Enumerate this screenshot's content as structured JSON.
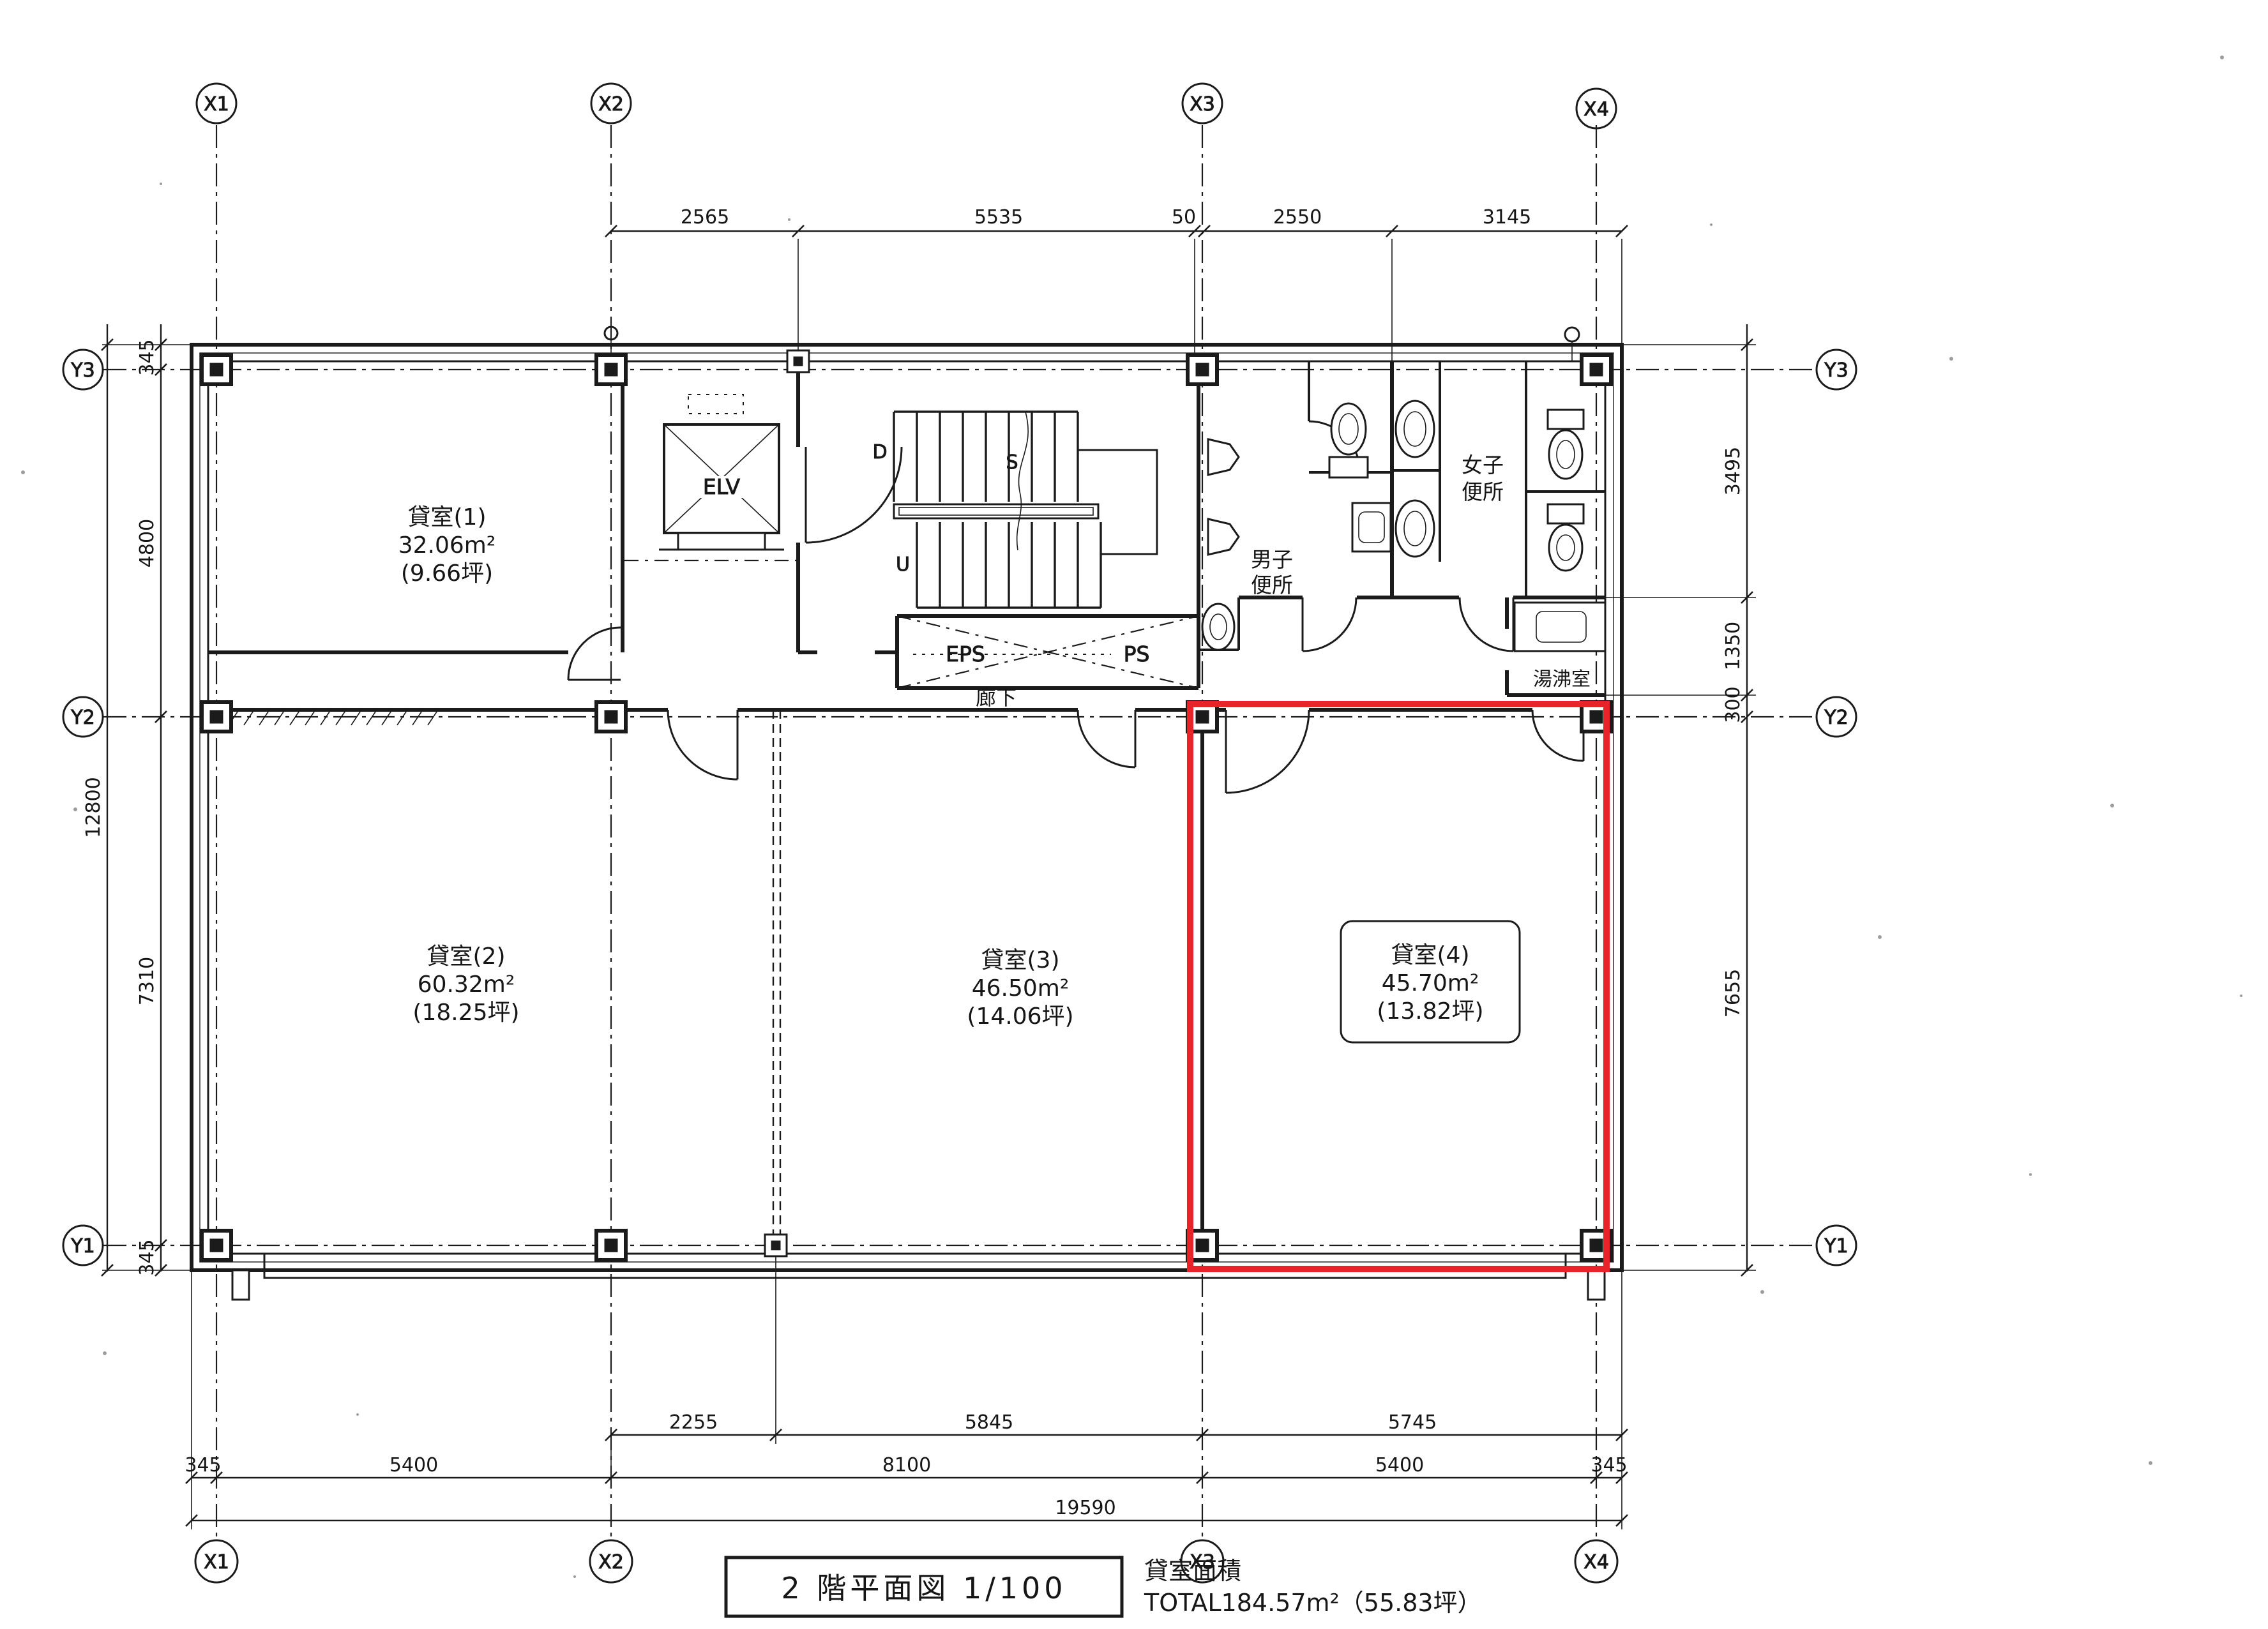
{
  "page": {
    "background": "#ffffff",
    "ink": "#1b1b1b",
    "highlight": "#e8232a"
  },
  "title_block": {
    "title": "2 階平面図  1/100"
  },
  "area_summary": {
    "heading": "貸室面積",
    "total": "TOTAL184.57m²（55.83坪）"
  },
  "grid": {
    "x": [
      "X1",
      "X2",
      "X3",
      "X4"
    ],
    "y": [
      "Y3",
      "Y2",
      "Y1"
    ]
  },
  "rooms": [
    {
      "name": "貸室(1)",
      "area": "32.06m²",
      "tsubo": "(9.66坪)"
    },
    {
      "name": "貸室(2)",
      "area": "60.32m²",
      "tsubo": "(18.25坪)"
    },
    {
      "name": "貸室(3)",
      "area": "46.50m²",
      "tsubo": "(14.06坪)"
    },
    {
      "name": "貸室(4)",
      "area": "45.70m²",
      "tsubo": "(13.82坪)"
    }
  ],
  "labels": {
    "elevator": "ELV",
    "corridor": "廊下",
    "eps": "EPS",
    "ps": "PS",
    "stair_down": "D",
    "stair_mid": "S",
    "stair_up": "U",
    "mens_line1": "男子",
    "mens_line2": "便所",
    "womens_line1": "女子",
    "womens_line2": "便所",
    "kitchenette": "湯沸室"
  },
  "dimensions": {
    "top": [
      "2565",
      "5535",
      "50",
      "2550",
      "3145"
    ],
    "bottom_inner": [
      "2255",
      "5845",
      "5745"
    ],
    "bottom_middle": [
      "345",
      "5400",
      "8100",
      "5400",
      "345"
    ],
    "bottom_overall": "19590",
    "left_inner": [
      "345",
      "4800",
      "7310",
      "345"
    ],
    "left_overall": "12800",
    "right": [
      "3495",
      "1350",
      "300",
      "7655"
    ]
  }
}
